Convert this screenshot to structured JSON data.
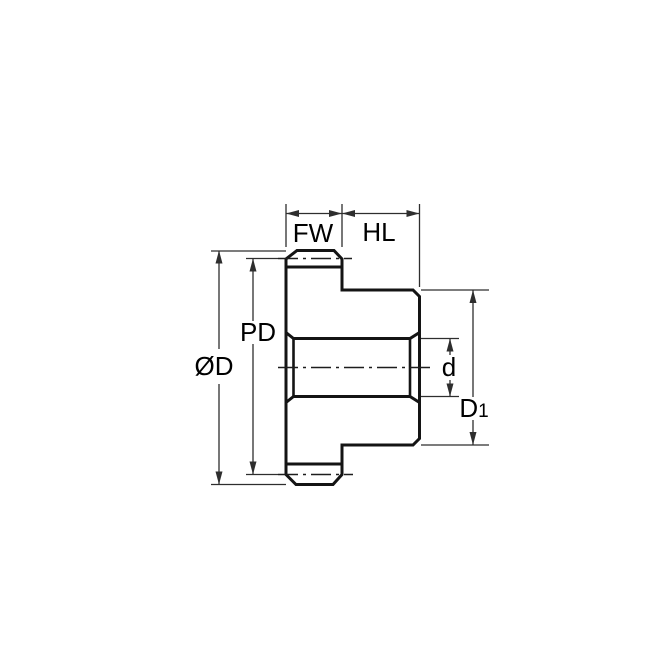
{
  "colors": {
    "background": "#FFFFFF",
    "part_fill": "#C6E7F8",
    "tooth_fill": "#FFFFFF",
    "outline": "#141414",
    "dimension_line": "#2E2E2E",
    "label_text": "#000000"
  },
  "labels": {
    "face_width": "FW",
    "hub_length": "HL",
    "outside_diameter": "ØD",
    "pitch_diameter": "PD",
    "bore_diameter": "d",
    "hub_diameter_base": "D",
    "hub_diameter_subscript": "1"
  }
}
